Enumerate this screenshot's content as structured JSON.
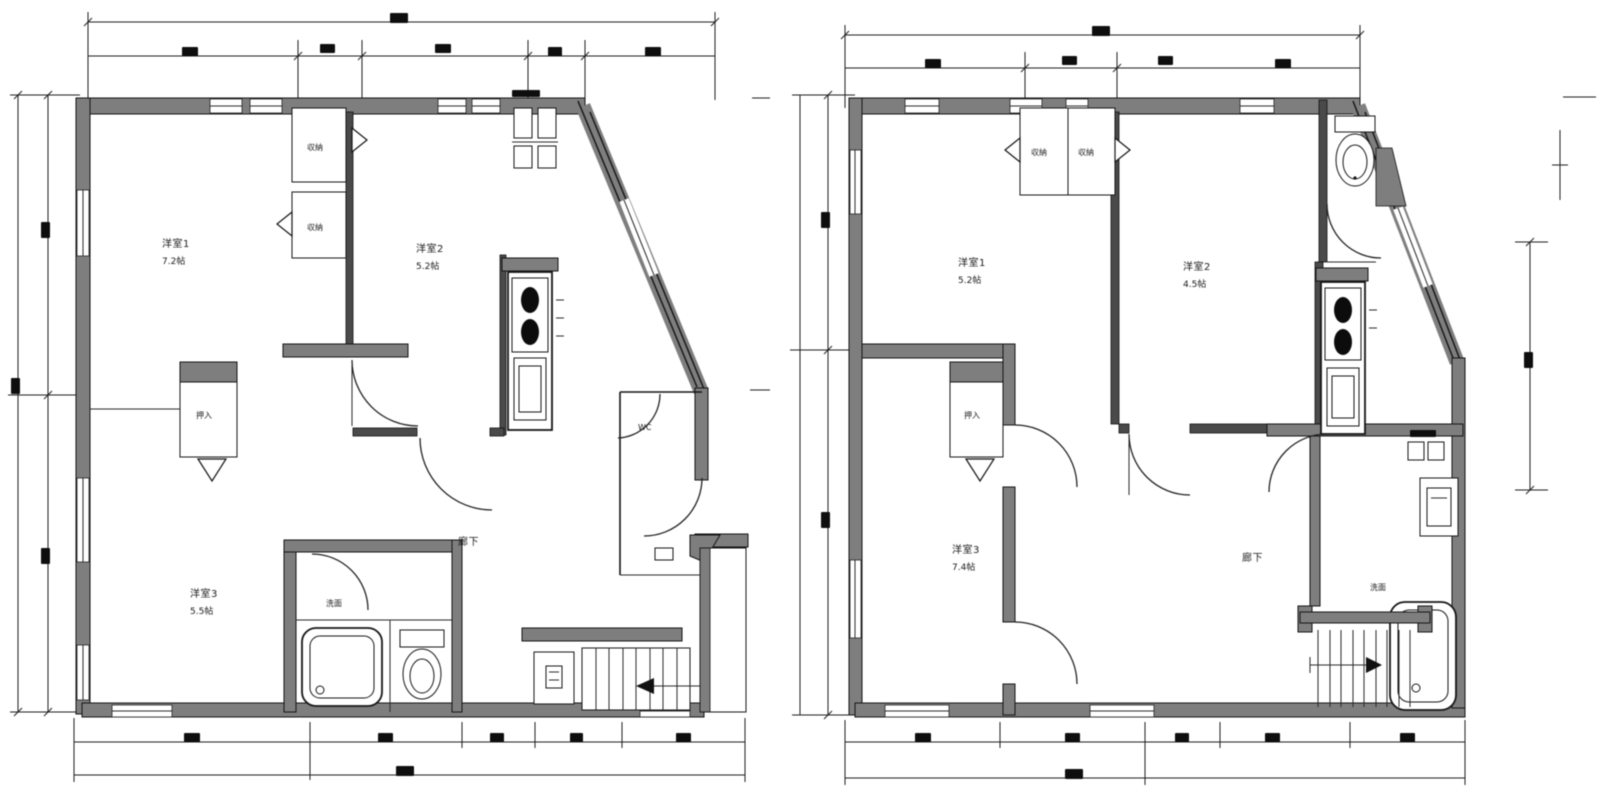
{
  "document": {
    "kind": "architectural floor plan drawing, two plans side by side, black and white"
  },
  "colors": {
    "background": "#ffffff",
    "wall_gray": "#7e7e7e",
    "line_black": "#141414"
  },
  "plan_left": {
    "rooms": {
      "room1": {
        "name": "洋室1",
        "size": "7.2帖"
      },
      "room2": {
        "name": "洋室2",
        "size": "5.2帖"
      },
      "room3": {
        "name": "洋室3",
        "size": "5.5帖"
      },
      "hall": {
        "name": "廊下"
      },
      "washroom": {
        "name": "洗面"
      },
      "wc": {
        "name": "WC"
      }
    },
    "closets": {
      "closet1": "収納",
      "closet2": "収納",
      "oshiire": "押入"
    }
  },
  "plan_right": {
    "rooms": {
      "room1": {
        "name": "洋室1",
        "size": "5.2帖"
      },
      "room2": {
        "name": "洋室2",
        "size": "4.5帖"
      },
      "room3": {
        "name": "洋室3",
        "size": "7.4帖"
      },
      "hall": {
        "name": "廊下"
      },
      "washroom": {
        "name": "洗面"
      }
    },
    "closets": {
      "closet1": "収納",
      "closet2": "収納",
      "oshiire": "押入"
    }
  }
}
